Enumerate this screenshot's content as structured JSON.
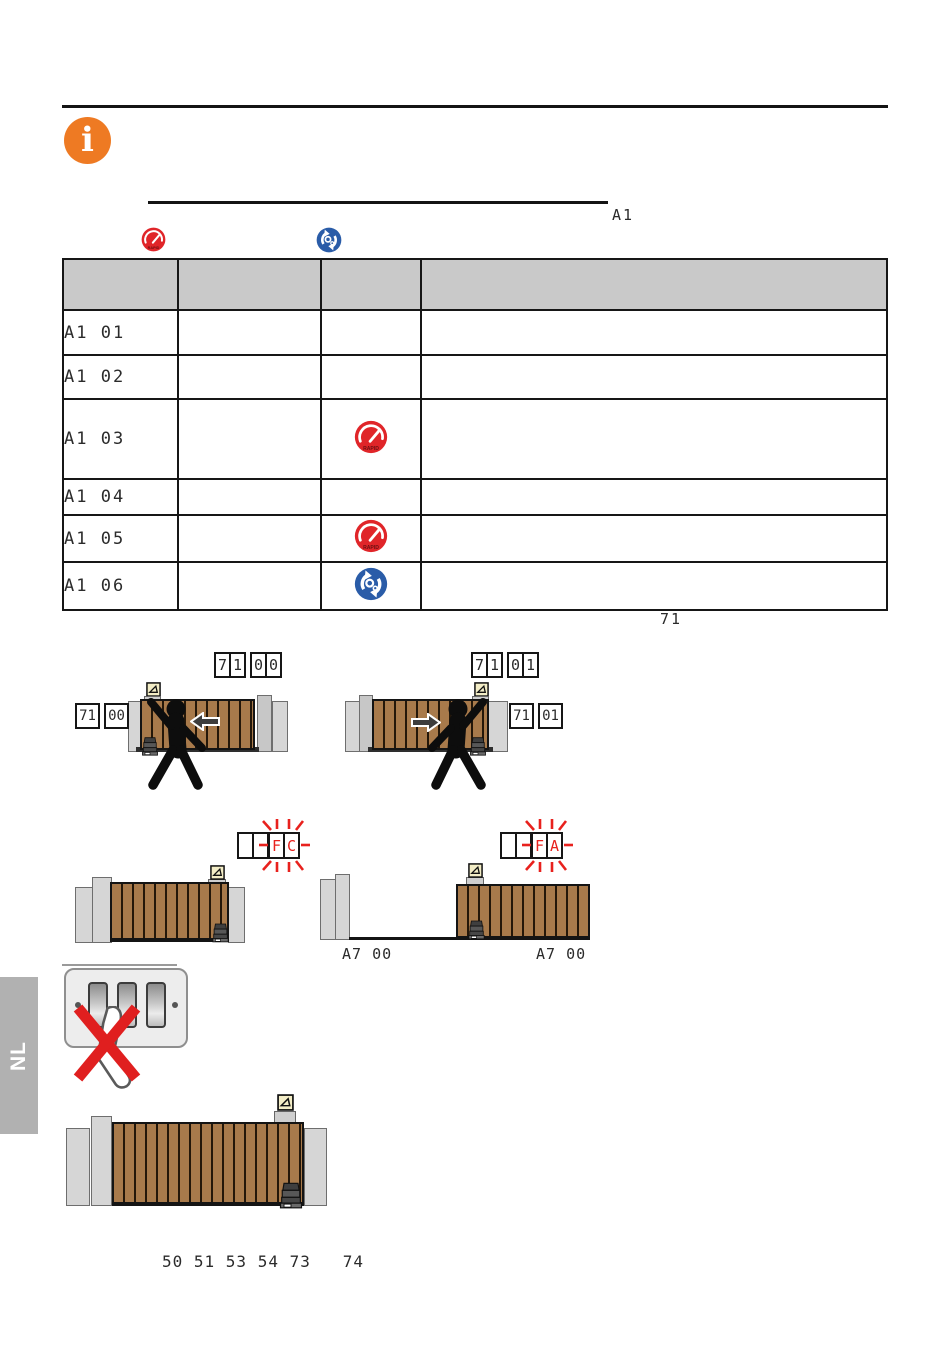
{
  "header": {
    "info_symbol": "i",
    "section_code": "A1"
  },
  "icons": {
    "rapid_text": "RAPID"
  },
  "table": {
    "rows": [
      {
        "code": "A1 01",
        "icon": ""
      },
      {
        "code": "A1 02",
        "icon": ""
      },
      {
        "code": "A1 03",
        "icon": "rapid"
      },
      {
        "code": "A1 04",
        "icon": ""
      },
      {
        "code": "A1 05",
        "icon": "rapid"
      },
      {
        "code": "A1 06",
        "icon": "service"
      }
    ],
    "footnote_code": "71"
  },
  "displays": {
    "limit_left_top": [
      "7",
      "1",
      "0",
      "0"
    ],
    "limit_left_side": [
      "71",
      "00"
    ],
    "limit_right_top": [
      "7",
      "1",
      "0",
      "1"
    ],
    "limit_right_side": [
      "71",
      "01"
    ],
    "fc": [
      "F",
      "C"
    ],
    "fa": [
      "F",
      "A"
    ],
    "open_label_left": "A7 00",
    "open_label_right": "A7 00"
  },
  "sidebar": {
    "language": "NL"
  },
  "terminals": "50 51 53 54 73   74",
  "colors": {
    "accent_orange": "#ee7a23",
    "rapid_red": "#e02529",
    "service_blue": "#2a5ca8",
    "blink_red": "#e8211d",
    "gate_brown": "#a87a4b",
    "table_header_gray": "#c9c9c9"
  }
}
